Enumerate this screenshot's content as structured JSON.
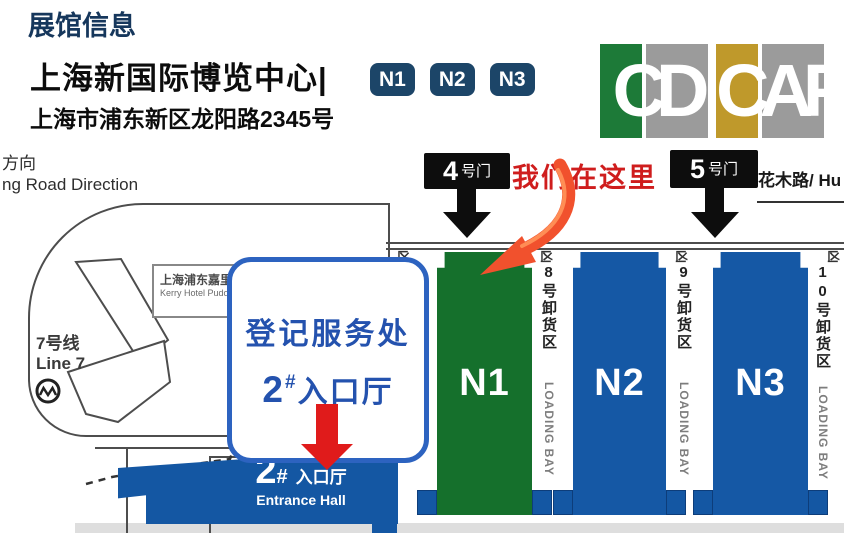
{
  "header": {
    "section_title": "展馆信息",
    "venue_name": "上海新国际博览中心|",
    "hall_badges": [
      "N1",
      "N2",
      "N3"
    ],
    "address": "上海市浦东新区龙阳路2345号",
    "logos": [
      {
        "letters": "CD",
        "primary_color": "#1d7a38",
        "secondary_color": "#9b9b9b"
      },
      {
        "letters": "CAF",
        "primary_color": "#bf992b",
        "secondary_color": "#9b9b9b"
      }
    ]
  },
  "map": {
    "road_left": {
      "line1": "方向",
      "line2": "ng Road Direction"
    },
    "road_right": "花木路/ Hu",
    "we_are_here": "我们在这里",
    "gate4": {
      "number": "4",
      "suffix": "号门"
    },
    "gate5": {
      "number": "5",
      "suffix": "号门"
    },
    "metro": {
      "line1": "7号线",
      "line2": "Line 7"
    },
    "hotel": {
      "cn": "上海浦东嘉里",
      "en": "Kerry Hotel Pudo"
    },
    "callout": {
      "line1": "登记服务处",
      "num": "2",
      "hash": "#",
      "rest": "入口厅"
    },
    "entrance": {
      "num": "2",
      "hash": "#",
      "cn": "入口厅",
      "en": "Entrance Hall"
    },
    "halls": [
      {
        "label": "N1",
        "color": "#15702c"
      },
      {
        "label": "N2",
        "color": "#1558a5"
      },
      {
        "label": "N3",
        "color": "#1558a5"
      }
    ],
    "loading_bays": [
      {
        "glyph": "凶",
        "cn": "",
        "en": "LOADING BAY"
      },
      {
        "glyph": "凶",
        "cn": "8号卸货区",
        "en": "LOADING BAY"
      },
      {
        "glyph": "凶",
        "cn": "9号卸货区",
        "en": "LOADING BAY"
      },
      {
        "glyph": "凶",
        "cn": "10号卸货区",
        "en": "LOADING BAY"
      }
    ]
  },
  "colors": {
    "title_navy": "#16375c",
    "badge_navy": "#1c4568",
    "accent_red": "#cf1d1d",
    "arrow_red": "#e01b1b",
    "arrow_orange": "#f1512d",
    "hall_green": "#15702c",
    "hall_blue": "#1558a5",
    "entrance_blue": "#1457a3",
    "callout_blue": "#2d63c0",
    "gate_black": "#0d0d0d"
  }
}
